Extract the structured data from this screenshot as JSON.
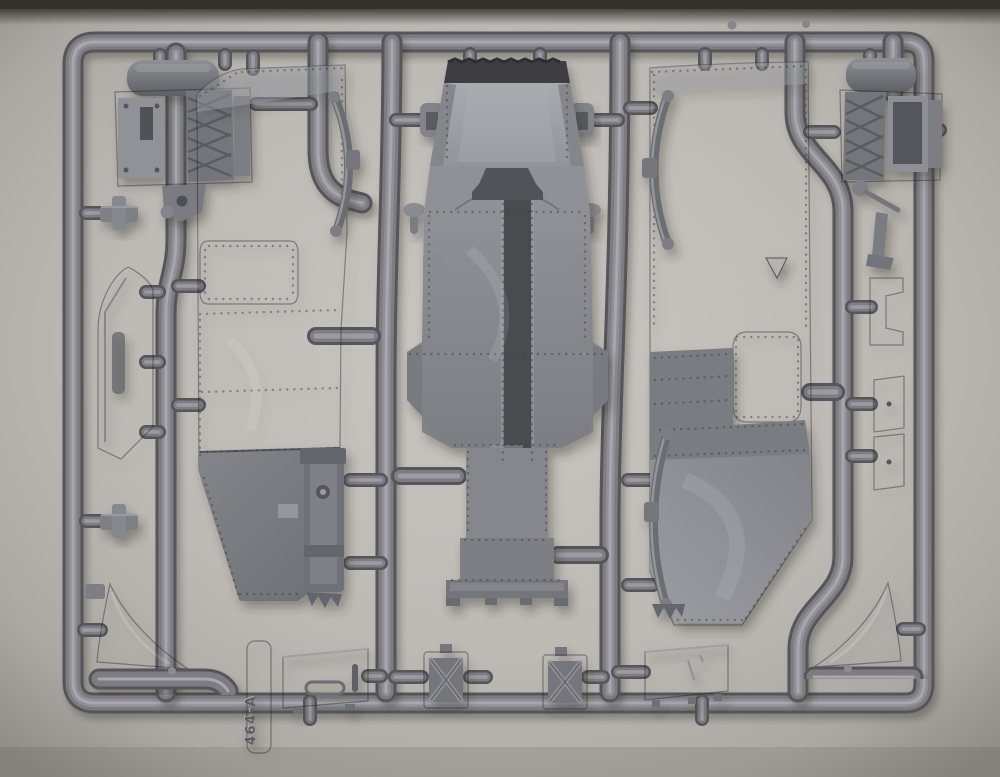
{
  "scene": {
    "type": "photograph",
    "subject": "Injection-molded grey styrene sprue (runner frame) of a scale plastic model kit containing armored-vehicle hull parts",
    "backdrop": "warm grey paper backdrop, vignetted toward the edges, dark strip along the very top edge"
  },
  "sprue": {
    "label": "464-A",
    "material": "grey polystyrene",
    "frame": "rounded rectangular outer runner with six internal vertical runners and many capsule-shaped gates"
  },
  "palette": {
    "backdrop": "#bfbbb6",
    "backdrop_edge": "#8f8b86",
    "top_edge_shadow": "#34322d",
    "runner_base": "#55555a",
    "runner_mid": "#7b7b81",
    "runner_highlight": "#a7a7ad",
    "part_light": "#9b9da2",
    "part_mid": "#85878c",
    "part_dark": "#5f6166",
    "detail_dark": "#44464b"
  },
  "parts": [
    {
      "id": "engine-block-left",
      "desc": "engine / radiator block half with cylinder and cross-ribbed grille, top left"
    },
    {
      "id": "engine-block-right",
      "desc": "mirrored engine / radiator block half, top right"
    },
    {
      "id": "hull-side-panel-left",
      "desc": "large riveted hull side panel with rounded hatch opening, angled lower plate and leaf springs"
    },
    {
      "id": "upper-hull-center",
      "desc": "central upper hull / superstructure with serrated top edge, riveted channel, flared sides and stepped base"
    },
    {
      "id": "hull-side-panel-right",
      "desc": "large riveted hull side panel with rounded vision-port opening, triangular cutout and leaf springs"
    },
    {
      "id": "fender-strip-left",
      "desc": "long angled fender strip with molded marking"
    },
    {
      "id": "leaf-spring-upper-left",
      "desc": "curved leaf spring molded beside left panel"
    },
    {
      "id": "leaf-spring-lower-left",
      "desc": "straight leaf spring with bolt and serrated end"
    },
    {
      "id": "leaf-spring-upper-right",
      "desc": "curved leaf spring molded beside right panel"
    },
    {
      "id": "leaf-spring-lower-right",
      "desc": "curved leaf spring with serrated end"
    },
    {
      "id": "visor-panel",
      "desc": "trapezoidal visor plate with recessed handle, bottom row"
    },
    {
      "id": "stowage-box-left",
      "desc": "stowage box with X strapping, bottom row"
    },
    {
      "id": "stowage-box-right",
      "desc": "second stowage box with X strapping, bottom row"
    },
    {
      "id": "floor-panel",
      "desc": "flat rectangular plate, bottom row"
    },
    {
      "id": "mud-flap-left",
      "desc": "curved mud flap, bottom left corner"
    },
    {
      "id": "mud-flap-right",
      "desc": "curved mud flap, bottom right corner"
    },
    {
      "id": "tow-rod-left",
      "desc": "straight rod with bent end, bottom left"
    },
    {
      "id": "tow-rod-right",
      "desc": "straight rod, bottom right"
    },
    {
      "id": "mounting-bracket-1",
      "desc": "small notched bracket, right edge"
    },
    {
      "id": "mounting-bracket-2",
      "desc": "small plate bracket, right edge"
    },
    {
      "id": "mounting-bracket-3",
      "desc": "small plate bracket, right edge"
    },
    {
      "id": "t-clamp-upper",
      "desc": "small T-shaped fitting, left edge"
    },
    {
      "id": "t-clamp-lower",
      "desc": "small T-shaped fitting, left edge"
    },
    {
      "id": "hatch-clamp-left",
      "desc": "small clamp fitting beside hull top"
    },
    {
      "id": "hatch-clamp-right",
      "desc": "small clamp fitting beside hull top"
    },
    {
      "id": "vision-plug-left",
      "desc": "small domed plug on stem"
    },
    {
      "id": "vision-plug-right",
      "desc": "small domed plug on stem"
    }
  ]
}
